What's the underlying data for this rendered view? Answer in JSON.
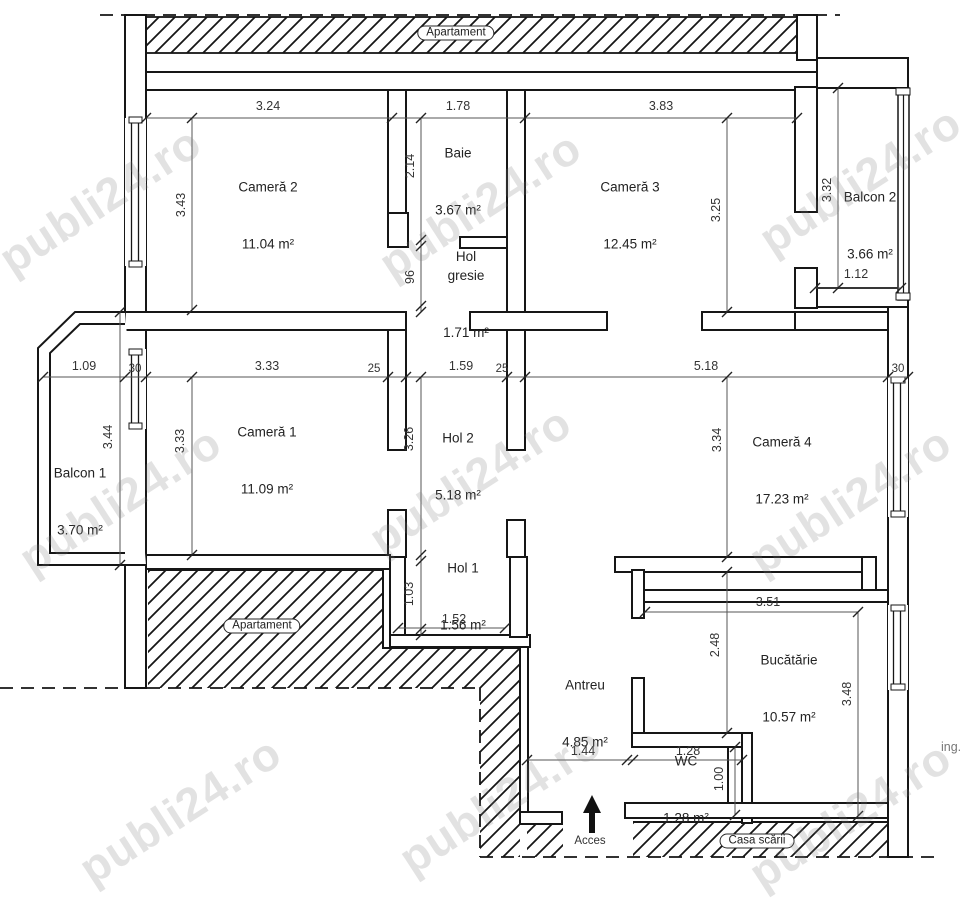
{
  "watermark": {
    "text": "publi24.ro"
  },
  "labels": {
    "apartament_top": "Apartament",
    "apartament_left": "Apartament",
    "casa_scarii": "Casa scării",
    "acces": "Acces",
    "ing": "ing."
  },
  "rooms": {
    "camera2": {
      "name": "Cameră 2",
      "area": "11.04 m²"
    },
    "baie": {
      "name": "Baie",
      "area": "3.67 m²"
    },
    "camera3": {
      "name": "Cameră 3",
      "area": "12.45 m²"
    },
    "balcon2": {
      "name": "Balcon 2",
      "area": "3.66 m²"
    },
    "hol_gresie": {
      "name": "Hol gresie",
      "area": "1.71 m²"
    },
    "camera1": {
      "name": "Cameră 1",
      "area": "11.09 m²"
    },
    "hol2": {
      "name": "Hol 2",
      "area": "5.18 m²"
    },
    "camera4": {
      "name": "Cameră 4",
      "area": "17.23 m²"
    },
    "balcon1": {
      "name": "Balcon 1",
      "area": "3.70 m²"
    },
    "hol1": {
      "name": "Hol 1",
      "area": "1.56 m²"
    },
    "antreu": {
      "name": "Antreu",
      "area": "4.85 m²"
    },
    "bucatarie": {
      "name": "Bucătărie",
      "area": "10.57 m²"
    },
    "wc": {
      "name": "WC",
      "area": "1.28 m²"
    }
  },
  "dims": {
    "camera2_w": "3.24",
    "baie_w": "1.78",
    "camera3_w": "3.83",
    "camera2_h": "3.43",
    "baie_h": "2.14",
    "hol_gresie_h": "96",
    "camera3_h": "3.25",
    "balcon2_h": "3.32",
    "balcon2_w": "1.12",
    "balcon1_w": "1.09",
    "window_left": "30",
    "camera1_w": "3.33",
    "wall_a": "25",
    "hol2_w": "1.59",
    "wall_b": "25",
    "camera4_w": "5.18",
    "window_right": "30",
    "balcon1_h": "3.44",
    "camera1_h": "3.33",
    "hol2_h": "3.26",
    "camera4_h": "3.34",
    "hol1_h": "1.03",
    "hol1_w": "1.52",
    "bucatarie_w": "3.51",
    "bucatarie_west_h": "2.48",
    "bucatarie_h": "3.48",
    "antreu_w": "1.44",
    "wc_w": "1.28",
    "wc_h": "1.00"
  }
}
